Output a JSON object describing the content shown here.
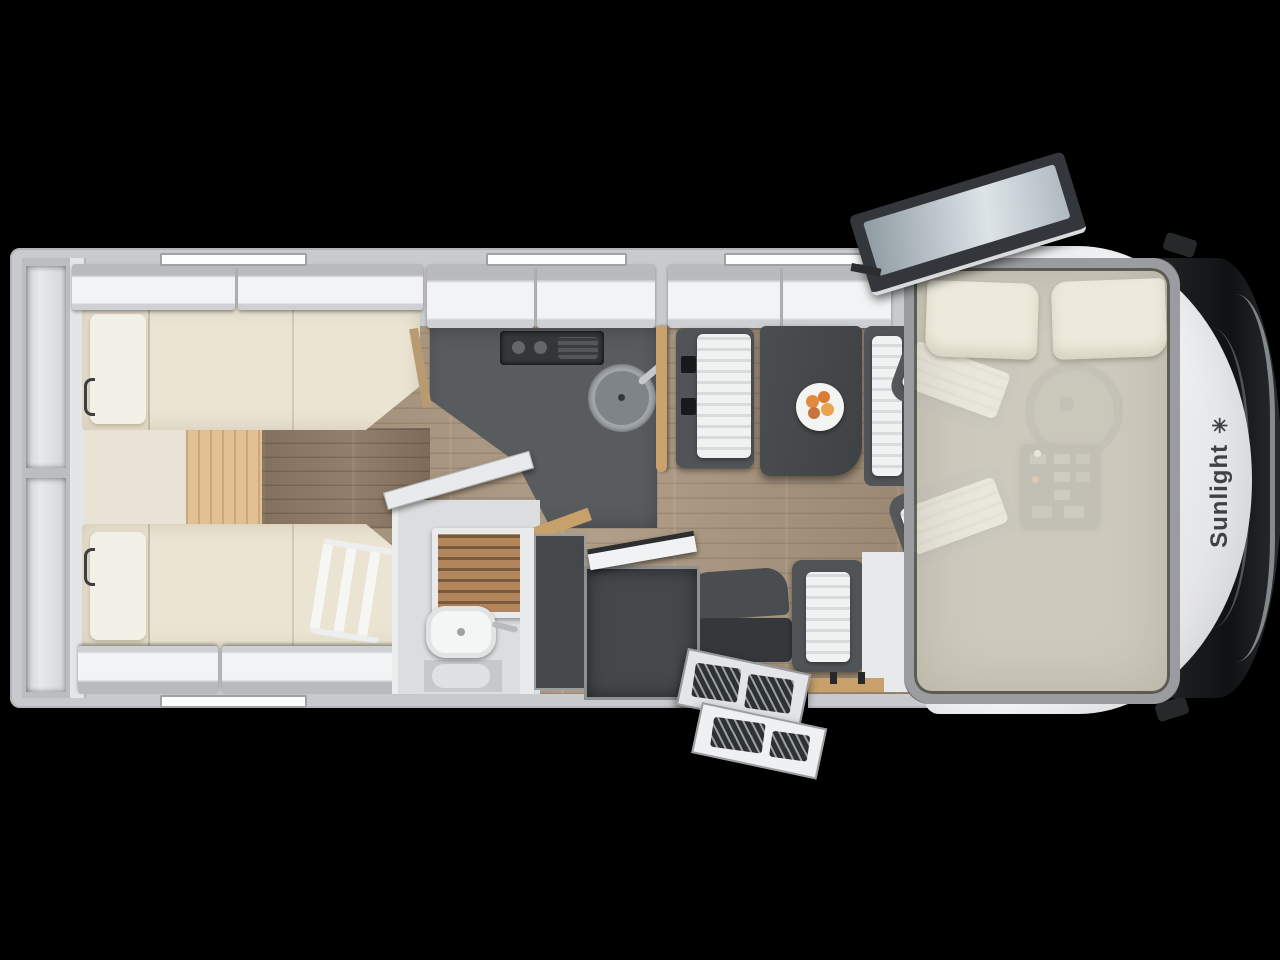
{
  "brand": {
    "name": "Sunlight",
    "star_icon": "✳"
  },
  "palette": {
    "background": "#000000",
    "body_white": "#f4f5f6",
    "wall_gray": "#c9cacd",
    "mattress_cream": "#ebe4d3",
    "floor_wood": "#a6947e",
    "accent_wood": "#c9a26b",
    "furniture_dark": "#4b4e51",
    "shower_teak": "#b3855a",
    "windshield_glass": "#17191b",
    "logo_text": "#3f4245"
  }
}
